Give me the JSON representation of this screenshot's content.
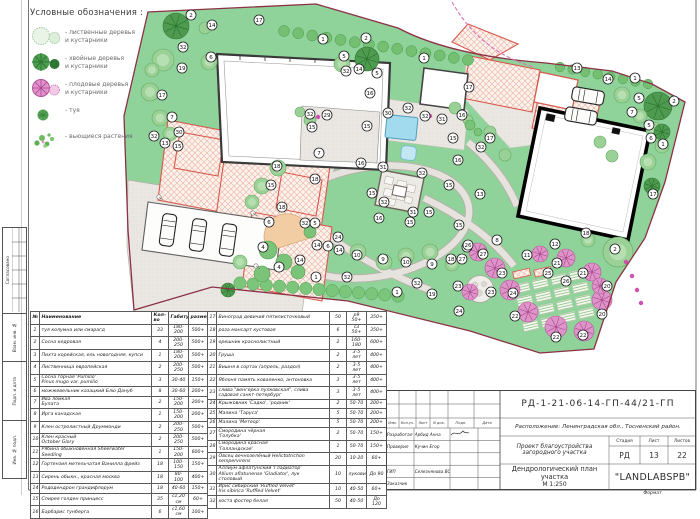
{
  "legend": {
    "title": "Условные обозначения :",
    "items": [
      {
        "icon": "deciduous-trees",
        "label": "- лиственные деревья\nи кустарники"
      },
      {
        "icon": "conifer-trees",
        "label": "- хвойные деревья\nи кустарники"
      },
      {
        "icon": "fruit-trees",
        "label": "- плодовые деревья\nи кустарники"
      },
      {
        "icon": "thuja",
        "label": "- туя"
      },
      {
        "icon": "climbing-plants",
        "label": "- вьющиеся растения"
      }
    ]
  },
  "plan": {
    "markers": [
      [
        2,
        191,
        15
      ],
      [
        14,
        212,
        25
      ],
      [
        17,
        259,
        20
      ],
      [
        1,
        323,
        39
      ],
      [
        2,
        366,
        38
      ],
      [
        32,
        183,
        47
      ],
      [
        6,
        211,
        57
      ],
      [
        19,
        182,
        68
      ],
      [
        5,
        344,
        56
      ],
      [
        32,
        346,
        71
      ],
      [
        14,
        359,
        69
      ],
      [
        5,
        377,
        73
      ],
      [
        16,
        370,
        93
      ],
      [
        17,
        162,
        95
      ],
      [
        7,
        172,
        117
      ],
      [
        32,
        154,
        136
      ],
      [
        30,
        179,
        132
      ],
      [
        13,
        165,
        143
      ],
      [
        15,
        178,
        146
      ],
      [
        32,
        310,
        114
      ],
      [
        29,
        327,
        115
      ],
      [
        15,
        312,
        127
      ],
      [
        7,
        319,
        153
      ],
      [
        15,
        367,
        126
      ],
      [
        16,
        361,
        163
      ],
      [
        30,
        388,
        113
      ],
      [
        32,
        408,
        108
      ],
      [
        1,
        424,
        58
      ],
      [
        17,
        469,
        87
      ],
      [
        13,
        577,
        68
      ],
      [
        14,
        608,
        79
      ],
      [
        1,
        635,
        78
      ],
      [
        5,
        639,
        98
      ],
      [
        2,
        674,
        101
      ],
      [
        7,
        632,
        112
      ],
      [
        5,
        649,
        125
      ],
      [
        6,
        651,
        138
      ],
      [
        1,
        663,
        144
      ],
      [
        32,
        425,
        116
      ],
      [
        31,
        442,
        119
      ],
      [
        16,
        462,
        115
      ],
      [
        15,
        453,
        138
      ],
      [
        32,
        481,
        147
      ],
      [
        17,
        490,
        138
      ],
      [
        16,
        458,
        160
      ],
      [
        15,
        449,
        185
      ],
      [
        13,
        480,
        194
      ],
      [
        17,
        653,
        194
      ],
      [
        18,
        277,
        166
      ],
      [
        15,
        271,
        185
      ],
      [
        18,
        315,
        179
      ],
      [
        18,
        282,
        207
      ],
      [
        31,
        383,
        167
      ],
      [
        32,
        422,
        173
      ],
      [
        15,
        372,
        193
      ],
      [
        32,
        384,
        202
      ],
      [
        31,
        413,
        212
      ],
      [
        15,
        429,
        212
      ],
      [
        15,
        410,
        222
      ],
      [
        16,
        379,
        218
      ],
      [
        15,
        459,
        225
      ],
      [
        6,
        269,
        222
      ],
      [
        32,
        305,
        223
      ],
      [
        5,
        315,
        223
      ],
      [
        24,
        338,
        237
      ],
      [
        14,
        317,
        245
      ],
      [
        6,
        328,
        246
      ],
      [
        14,
        339,
        250
      ],
      [
        10,
        357,
        255
      ],
      [
        4,
        263,
        247
      ],
      [
        4,
        279,
        267
      ],
      [
        14,
        300,
        260
      ],
      [
        9,
        383,
        259
      ],
      [
        10,
        406,
        262
      ],
      [
        9,
        432,
        264
      ],
      [
        1,
        316,
        277
      ],
      [
        32,
        347,
        277
      ],
      [
        28,
        467,
        247
      ],
      [
        18,
        451,
        259
      ],
      [
        27,
        462,
        259
      ],
      [
        23,
        458,
        286
      ],
      [
        1,
        397,
        292
      ],
      [
        32,
        417,
        283
      ],
      [
        19,
        432,
        294
      ],
      [
        24,
        459,
        311
      ],
      [
        8,
        497,
        240
      ],
      [
        26,
        468,
        245
      ],
      [
        27,
        483,
        254
      ],
      [
        12,
        555,
        244
      ],
      [
        11,
        527,
        255
      ],
      [
        2,
        615,
        249
      ],
      [
        21,
        557,
        263
      ],
      [
        21,
        583,
        273
      ],
      [
        23,
        502,
        273
      ],
      [
        25,
        548,
        273
      ],
      [
        26,
        566,
        281
      ],
      [
        23,
        491,
        292
      ],
      [
        24,
        513,
        293
      ],
      [
        20,
        607,
        286
      ],
      [
        20,
        602,
        314
      ],
      [
        22,
        515,
        316
      ],
      [
        22,
        556,
        337
      ],
      [
        22,
        583,
        335
      ],
      [
        18,
        586,
        233
      ]
    ]
  },
  "plant_table": {
    "headers": [
      "№",
      "Наименование",
      "Кол-во",
      "Габитус",
      "размер"
    ],
    "rows_left": [
      [
        "1",
        "туя колумна или смарагд",
        "33",
        "180-200",
        "500+"
      ],
      [
        "2",
        "Сосна кедровая",
        "4",
        "200-250",
        "500+"
      ],
      [
        "3",
        "Пихта корейская, ель новогодняя, купси",
        "1",
        "180-200",
        "500+"
      ],
      [
        "4",
        "Лиственница европейская",
        "2",
        "200-250",
        "500+"
      ],
      [
        "5",
        "Сосна горная 'Pumilio'\nPinus mugo var. pumilio",
        "3",
        "30-40",
        "150+"
      ],
      [
        "6",
        "можжевельник казацкий Блю Дануб",
        "8",
        "30-60",
        "200+"
      ],
      [
        "7",
        "Ива ломкая\nБулата",
        "2",
        "150-200",
        "200+"
      ],
      [
        "8",
        "Ирга канадская",
        "1",
        "150-200",
        "200+"
      ],
      [
        "9",
        "Клен остролистный Друммонди",
        "2",
        "200-250",
        "500+"
      ],
      [
        "10",
        "Клен красный\nOctober Glory",
        "2",
        "200-250",
        "500+"
      ],
      [
        "11",
        "Рябина обыкновенная Sheerwater\nSeedling",
        "1",
        "150-200",
        "600+"
      ],
      [
        "12",
        "Гортензия метельчатая Ванилла фрейз",
        "18",
        "100-150",
        "150+"
      ],
      [
        "13",
        "Сирень обыкн., красная москва",
        "18",
        "80-100",
        "400+"
      ],
      [
        "14",
        "Рододендрон грандифлорум",
        "18",
        "40-60",
        "150+"
      ],
      [
        "15",
        "Спирея голден принцесс",
        "35",
        "с1,20 см",
        "60+"
      ],
      [
        "16",
        "Барбарис тунберга",
        "6",
        "с1,60 см",
        "100+"
      ]
    ],
    "rows_right": [
      [
        "17",
        "Виноград девичий пятилисточковый",
        "50",
        "р9 50+",
        "350+"
      ],
      [
        "18",
        "роза мансарт кустовая",
        "6",
        "с3 50+",
        "350+"
      ],
      [
        "19",
        "орешник краснолистный",
        "2",
        "160-180",
        "600+"
      ],
      [
        "20",
        "Груша",
        "2",
        "3-5 лет",
        "400+"
      ],
      [
        "21",
        "Вишня в сортах (апрель, раздол)",
        "2",
        "3-5 лет",
        "400+"
      ],
      [
        "22",
        "Яблоня память коваленко, антоновка",
        "3",
        "3-5 лет",
        "400+"
      ],
      [
        "23",
        "слива \"венгерка пулковская\", слива\nсадовая санкт-петербург",
        "3",
        "3-5 лет",
        "400+"
      ],
      [
        "24",
        "Крыжовник 'Садко', 'родник'",
        "2",
        "50-70",
        "200+"
      ],
      [
        "25",
        "Малина 'Таруса'",
        "5",
        "50-70",
        "200+"
      ],
      [
        "26",
        "Малина 'Метеор'",
        "5",
        "50-70",
        "200+"
      ],
      [
        "27",
        "Смородина чёрная\n'Голубка'",
        "2",
        "50-70",
        "150+"
      ],
      [
        "28",
        "Смородина красная\n'Голландская'",
        "1",
        "50-70",
        "150+"
      ],
      [
        "29",
        "Овсец вечнозелёный Helictotrichon\nsempervirens",
        "20",
        "10-20",
        "60+"
      ],
      [
        "30",
        "Аллиум афлатунский 'Гладиатор'\nAllium aflatunense 'Gladiator', лук\nстоловый",
        "10",
        "луковица",
        "До 90"
      ],
      [
        "31",
        "Ирис сибирский 'Ruffled Velvet'\nIris sibirica 'Ruffled Velvet'",
        "10",
        "40-50",
        "60+"
      ],
      [
        "32",
        "хоста фостер белая",
        "50",
        "40-50",
        "До 120"
      ]
    ]
  },
  "title_block": {
    "doc_number": "РД-1-21-06-14-ГП-44/21-ГП",
    "location": "Расположение: Ленинградская обл., Тосненский район.",
    "project": "Проект благоустройства загородного участка",
    "stage_label": "Стадия",
    "sheet_label": "Лист",
    "sheets_label": "Листов",
    "stage": "РД",
    "sheet": "13",
    "sheets": "22",
    "drawing_title": "Дендрологический план участка",
    "scale": "М 1:250",
    "company": "\"LANDLABSPB\"",
    "format_label": "Формат",
    "header_cols": [
      "Изм.",
      "Кол.уч.",
      "Лист",
      "N док.",
      "Подп.",
      "Дата"
    ],
    "rows": [
      {
        "role": "Разработал",
        "name": "Арбид Анна"
      },
      {
        "role": "Проверил",
        "name": "Кучин Егор"
      },
      {
        "role": "",
        "name": ""
      },
      {
        "role": "ГИП",
        "name": "Селезнянова ВС"
      },
      {
        "role": "Заказчик",
        "name": ""
      }
    ]
  },
  "frame": {
    "labels": [
      "Согласовано",
      "Взам. инв. №",
      "Подп. и дата",
      "Инв. № подл."
    ]
  },
  "colors": {
    "lawn": "#8fd39a",
    "boundary": "#8c3145",
    "red_hatch": "#d8584c",
    "pool": "#a2daee",
    "fruit_tree": "#df94c9",
    "conifer": "#4e9b4f"
  }
}
